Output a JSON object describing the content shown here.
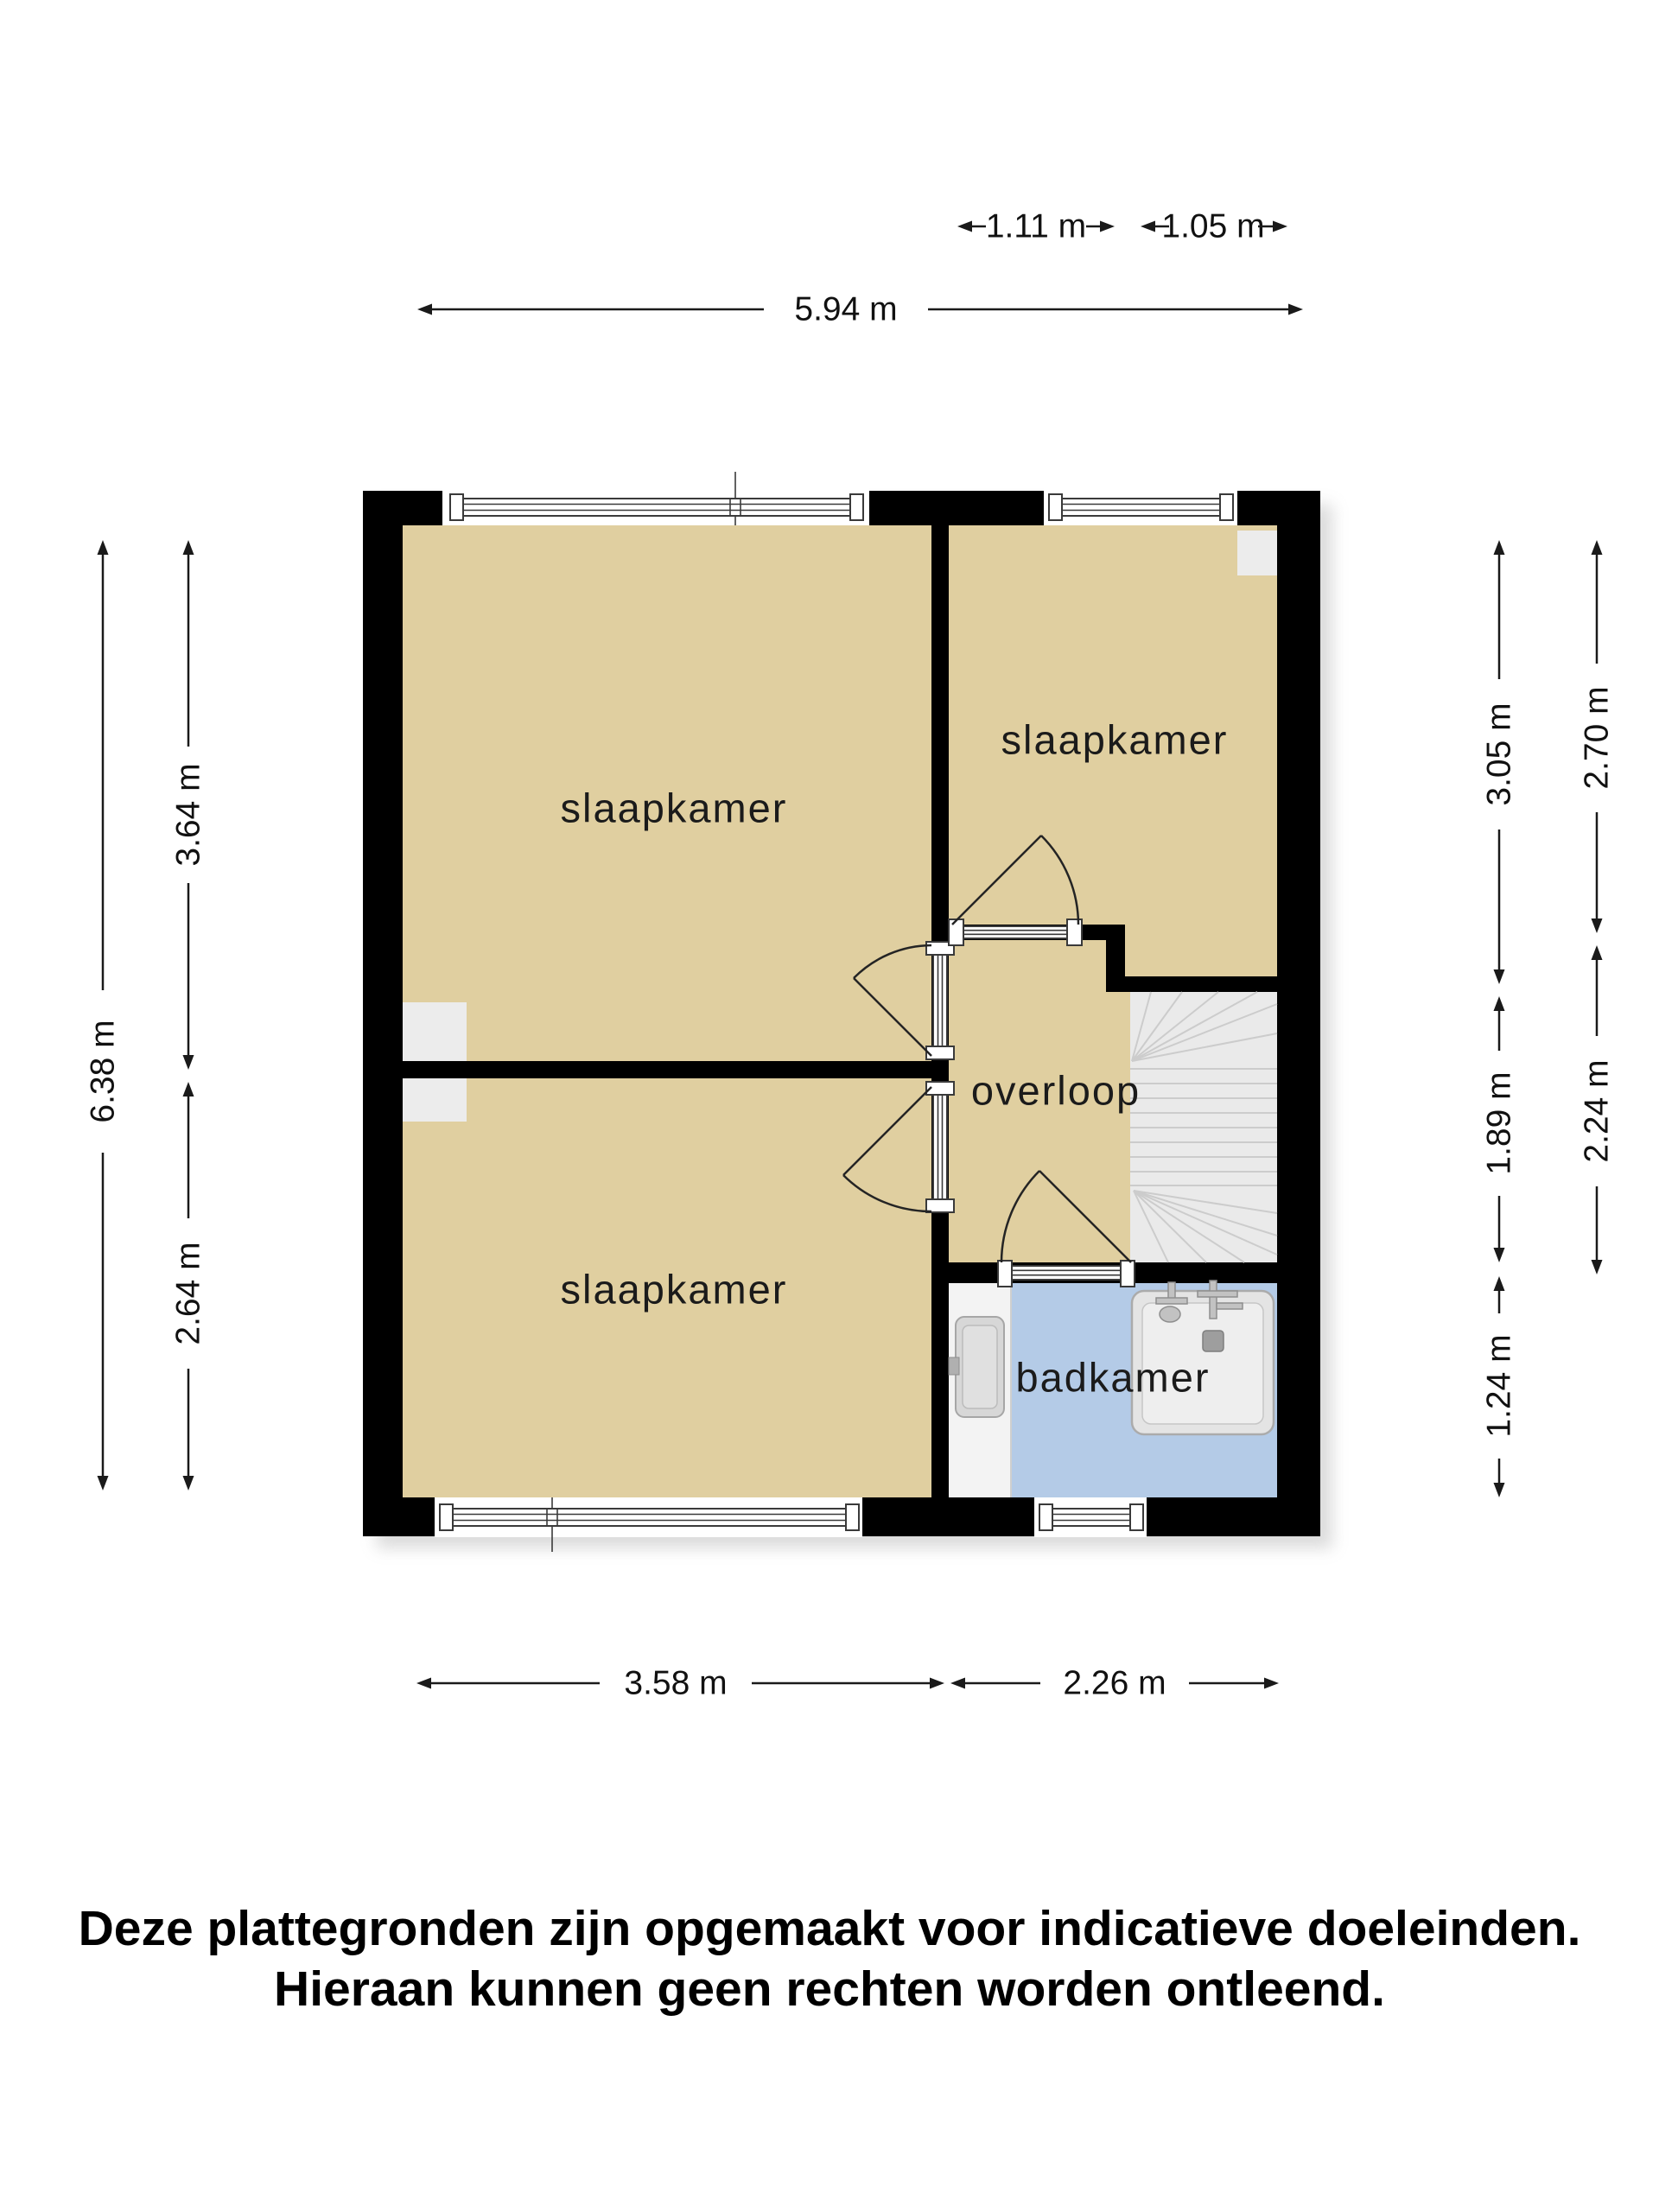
{
  "floorplan": {
    "title": "upper floor plan",
    "rooms": [
      {
        "name": "slaapkamer-top-left",
        "label": "slaapkamer"
      },
      {
        "name": "slaapkamer-top-right",
        "label": "slaapkamer"
      },
      {
        "name": "slaapkamer-bottom-left",
        "label": "slaapkamer"
      },
      {
        "name": "overloop",
        "label": "overloop"
      },
      {
        "name": "badkamer",
        "label": "badkamer"
      }
    ],
    "colors": {
      "wall": "#000000",
      "room_floor": "#e0cfa0",
      "bathroom_floor": "#b4cbe7",
      "stairs": "#eaeaea",
      "chimney": "#ececec",
      "counter": "#f3f3f3",
      "page_background": "#ffffff"
    },
    "dimensions": {
      "top_small": [
        {
          "label": "1.11 m"
        },
        {
          "label": "1.05 m"
        }
      ],
      "top_total": {
        "label": "5.94 m"
      },
      "left_outer": {
        "label": "6.38 m"
      },
      "left_inner": [
        {
          "label": "3.64 m"
        },
        {
          "label": "2.64 m"
        }
      ],
      "right_inner": [
        {
          "label": "3.05 m"
        },
        {
          "label": "1.89 m"
        },
        {
          "label": "1.24 m"
        }
      ],
      "right_outer": [
        {
          "label": "2.70 m"
        },
        {
          "label": "2.24 m"
        }
      ],
      "bottom": [
        {
          "label": "3.58 m"
        },
        {
          "label": "2.26 m"
        }
      ]
    },
    "disclaimer": {
      "line1": "Deze plattegronden zijn opgemaakt voor indicatieve doeleinden.",
      "line2": "Hieraan kunnen geen rechten worden ontleend."
    }
  }
}
